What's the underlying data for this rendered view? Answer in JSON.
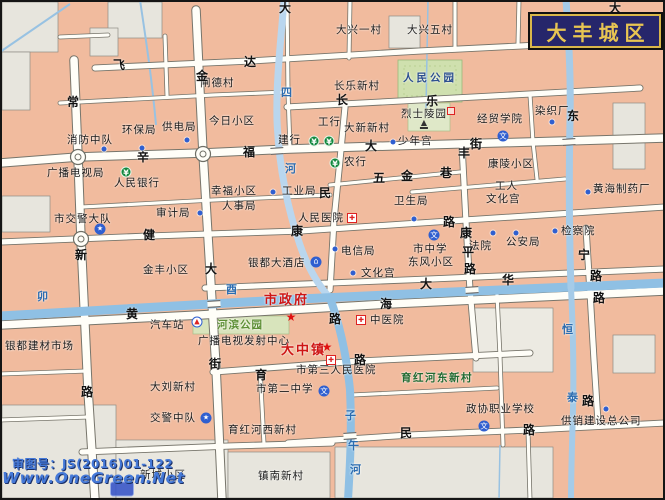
{
  "title": {
    "text": "大丰城区"
  },
  "watermark": {
    "approval": "审图号：JS(2016)01-122",
    "site": "Www.OneGreen.Net"
  },
  "colors": {
    "block": "#f1bb9e",
    "gray_block": "#e7e5dd",
    "road": "#fffef8",
    "river": "#8fc0e4",
    "park": "#cfe0ae",
    "title_bg": "#26266b",
    "title_text": "#e8c552",
    "red_label": "#ce1515"
  },
  "map": {
    "labels": [
      {
        "t": "闸德村",
        "x": 200,
        "y": 78
      },
      {
        "t": "大兴一村",
        "x": 336,
        "y": 25
      },
      {
        "t": "大兴五村",
        "x": 407,
        "y": 25
      },
      {
        "t": "长乐新村",
        "x": 334,
        "y": 81
      },
      {
        "t": "大新新村",
        "x": 344,
        "y": 123
      },
      {
        "t": "今日小区",
        "x": 209,
        "y": 116
      },
      {
        "t": "消防中队",
        "x": 67,
        "y": 135
      },
      {
        "t": "环保局",
        "x": 122,
        "y": 125
      },
      {
        "t": "供电局",
        "x": 162,
        "y": 122
      },
      {
        "t": "广播电视局",
        "x": 47,
        "y": 168
      },
      {
        "t": "人民银行",
        "x": 114,
        "y": 178
      },
      {
        "t": "市交警大队",
        "x": 54,
        "y": 214
      },
      {
        "t": "审计局",
        "x": 156,
        "y": 208
      },
      {
        "t": "人事局",
        "x": 222,
        "y": 201
      },
      {
        "t": "幸福小区",
        "x": 211,
        "y": 186
      },
      {
        "t": "工业局",
        "x": 282,
        "y": 186
      },
      {
        "t": "工行",
        "x": 318,
        "y": 117
      },
      {
        "t": "建行",
        "x": 278,
        "y": 135
      },
      {
        "t": "农行",
        "x": 344,
        "y": 157
      },
      {
        "t": "少年宫",
        "x": 398,
        "y": 136
      },
      {
        "t": "经贸学院",
        "x": 477,
        "y": 114
      },
      {
        "t": "染织厂",
        "x": 535,
        "y": 106
      },
      {
        "t": "烈士陵园",
        "x": 401,
        "y": 109
      },
      {
        "t": "人民公园",
        "x": 403,
        "y": 73,
        "c": "park"
      },
      {
        "t": "卫生局",
        "x": 394,
        "y": 196
      },
      {
        "t": "人民医院",
        "x": 298,
        "y": 213
      },
      {
        "t": "工人",
        "x": 495,
        "y": 181
      },
      {
        "t": "文化宫",
        "x": 486,
        "y": 194
      },
      {
        "t": "黄海制药厂",
        "x": 593,
        "y": 184
      },
      {
        "t": "检察院",
        "x": 561,
        "y": 226
      },
      {
        "t": "法院",
        "x": 469,
        "y": 241
      },
      {
        "t": "公安局",
        "x": 506,
        "y": 237
      },
      {
        "t": "市中学",
        "x": 413,
        "y": 244
      },
      {
        "t": "东风小区",
        "x": 408,
        "y": 257
      },
      {
        "t": "电信局",
        "x": 341,
        "y": 246
      },
      {
        "t": "文化宫",
        "x": 361,
        "y": 268
      },
      {
        "t": "金丰小区",
        "x": 143,
        "y": 265
      },
      {
        "t": "银都大酒店",
        "x": 248,
        "y": 258
      },
      {
        "t": "市政府",
        "x": 264,
        "y": 294,
        "c": "red"
      },
      {
        "t": "大中镇",
        "x": 281,
        "y": 344,
        "c": "red"
      },
      {
        "t": "汽车站",
        "x": 150,
        "y": 320
      },
      {
        "t": "河滨公园",
        "x": 217,
        "y": 320,
        "c": "green"
      },
      {
        "t": "广播电视发射中心",
        "x": 198,
        "y": 336
      },
      {
        "t": "银都建材市场",
        "x": 5,
        "y": 341
      },
      {
        "t": "大刘新村",
        "x": 150,
        "y": 382
      },
      {
        "t": "市第三人民医院",
        "x": 296,
        "y": 365
      },
      {
        "t": "市第二中学",
        "x": 256,
        "y": 384
      },
      {
        "t": "育红河东新村",
        "x": 401,
        "y": 373,
        "c": "gvillage"
      },
      {
        "t": "中医院",
        "x": 370,
        "y": 315
      },
      {
        "t": "交警中队",
        "x": 150,
        "y": 413
      },
      {
        "t": "育红河西新村",
        "x": 228,
        "y": 425
      },
      {
        "t": "新城小区",
        "x": 140,
        "y": 470
      },
      {
        "t": "镇南新村",
        "x": 258,
        "y": 471
      },
      {
        "t": "政协职业学校",
        "x": 466,
        "y": 404
      },
      {
        "t": "供销建设总公司",
        "x": 561,
        "y": 416
      },
      {
        "t": "康陵小区",
        "x": 488,
        "y": 159
      },
      {
        "t": "常",
        "x": 67,
        "y": 96,
        "c": "street"
      },
      {
        "t": "新",
        "x": 75,
        "y": 249,
        "c": "street"
      },
      {
        "t": "路",
        "x": 81,
        "y": 386,
        "c": "street"
      },
      {
        "t": "金",
        "x": 196,
        "y": 70,
        "c": "street"
      },
      {
        "t": "达",
        "x": 244,
        "y": 56,
        "c": "street"
      },
      {
        "t": "飞",
        "x": 113,
        "y": 59,
        "c": "street"
      },
      {
        "t": "大",
        "x": 279,
        "y": 2,
        "c": "street"
      },
      {
        "t": "大",
        "x": 609,
        "y": 2,
        "c": "street"
      },
      {
        "t": "辛",
        "x": 137,
        "y": 151,
        "c": "street"
      },
      {
        "t": "福",
        "x": 243,
        "y": 146,
        "c": "street"
      },
      {
        "t": "大",
        "x": 365,
        "y": 140,
        "c": "street"
      },
      {
        "t": "街",
        "x": 470,
        "y": 138,
        "c": "street"
      },
      {
        "t": "丰",
        "x": 458,
        "y": 147,
        "c": "street"
      },
      {
        "t": "健",
        "x": 143,
        "y": 229,
        "c": "street"
      },
      {
        "t": "康",
        "x": 291,
        "y": 225,
        "c": "street"
      },
      {
        "t": "路",
        "x": 443,
        "y": 216,
        "c": "street"
      },
      {
        "t": "康",
        "x": 460,
        "y": 227,
        "c": "street"
      },
      {
        "t": "平",
        "x": 462,
        "y": 246,
        "c": "street"
      },
      {
        "t": "路",
        "x": 464,
        "y": 263,
        "c": "street"
      },
      {
        "t": "大",
        "x": 205,
        "y": 263,
        "c": "street"
      },
      {
        "t": "街",
        "x": 209,
        "y": 358,
        "c": "street"
      },
      {
        "t": "大",
        "x": 420,
        "y": 278,
        "c": "street"
      },
      {
        "t": "华",
        "x": 502,
        "y": 274,
        "c": "street"
      },
      {
        "t": "路",
        "x": 590,
        "y": 270,
        "c": "street"
      },
      {
        "t": "黄",
        "x": 126,
        "y": 308,
        "c": "street"
      },
      {
        "t": "海",
        "x": 380,
        "y": 298,
        "c": "street"
      },
      {
        "t": "路",
        "x": 329,
        "y": 313,
        "c": "street"
      },
      {
        "t": "路",
        "x": 593,
        "y": 292,
        "c": "street"
      },
      {
        "t": "宁",
        "x": 578,
        "y": 249,
        "c": "street"
      },
      {
        "t": "路",
        "x": 354,
        "y": 354,
        "c": "street"
      },
      {
        "t": "民",
        "x": 400,
        "y": 427,
        "c": "street"
      },
      {
        "t": "路",
        "x": 523,
        "y": 424,
        "c": "street"
      },
      {
        "t": "路",
        "x": 582,
        "y": 395,
        "c": "street"
      },
      {
        "t": "育",
        "x": 255,
        "y": 369,
        "c": "street"
      },
      {
        "t": "五",
        "x": 373,
        "y": 172,
        "c": "street"
      },
      {
        "t": "金",
        "x": 401,
        "y": 170,
        "c": "street"
      },
      {
        "t": "巷",
        "x": 440,
        "y": 167,
        "c": "street"
      },
      {
        "t": "民",
        "x": 319,
        "y": 187,
        "c": "street"
      },
      {
        "t": "长",
        "x": 336,
        "y": 94,
        "c": "street"
      },
      {
        "t": "乐",
        "x": 426,
        "y": 95,
        "c": "street"
      },
      {
        "t": "东",
        "x": 567,
        "y": 110,
        "c": "street"
      },
      {
        "t": "四",
        "x": 281,
        "y": 87,
        "c": "river"
      },
      {
        "t": "河",
        "x": 285,
        "y": 163,
        "c": "river"
      },
      {
        "t": "卯",
        "x": 37,
        "y": 291,
        "c": "river"
      },
      {
        "t": "酉",
        "x": 226,
        "y": 284,
        "c": "river"
      },
      {
        "t": "恒",
        "x": 562,
        "y": 324,
        "c": "river"
      },
      {
        "t": "泰",
        "x": 567,
        "y": 392,
        "c": "river"
      },
      {
        "t": "子",
        "x": 345,
        "y": 410,
        "c": "river"
      },
      {
        "t": "午",
        "x": 348,
        "y": 440,
        "c": "river"
      },
      {
        "t": "河",
        "x": 350,
        "y": 464,
        "c": "river"
      }
    ],
    "icons": [
      {
        "k": "yuan",
        "x": 314,
        "y": 141
      },
      {
        "k": "yuan",
        "x": 329,
        "y": 141
      },
      {
        "k": "yuan",
        "x": 335,
        "y": 163
      },
      {
        "k": "yuan",
        "x": 126,
        "y": 172
      },
      {
        "k": "cross",
        "x": 352,
        "y": 218
      },
      {
        "k": "cross",
        "x": 361,
        "y": 320
      },
      {
        "k": "cross",
        "x": 331,
        "y": 360
      },
      {
        "k": "school",
        "x": 503,
        "y": 136
      },
      {
        "k": "school",
        "x": 434,
        "y": 235
      },
      {
        "k": "school",
        "x": 324,
        "y": 391
      },
      {
        "k": "school",
        "x": 484,
        "y": 426
      },
      {
        "k": "police",
        "x": 100,
        "y": 229
      },
      {
        "k": "police",
        "x": 206,
        "y": 418
      },
      {
        "k": "bus",
        "x": 197,
        "y": 322
      },
      {
        "k": "hotel",
        "x": 316,
        "y": 262
      },
      {
        "k": "redstar",
        "x": 291,
        "y": 317
      },
      {
        "k": "redstar",
        "x": 327,
        "y": 347
      },
      {
        "k": "monument",
        "x": 424,
        "y": 124
      },
      {
        "k": "redbox",
        "x": 451,
        "y": 111
      },
      {
        "k": "dot",
        "x": 393,
        "y": 142
      },
      {
        "k": "dot",
        "x": 552,
        "y": 122
      },
      {
        "k": "dot",
        "x": 588,
        "y": 192
      },
      {
        "k": "dot",
        "x": 555,
        "y": 231
      },
      {
        "k": "dot",
        "x": 493,
        "y": 233
      },
      {
        "k": "dot",
        "x": 516,
        "y": 233
      },
      {
        "k": "dot",
        "x": 414,
        "y": 219
      },
      {
        "k": "dot",
        "x": 353,
        "y": 273
      },
      {
        "k": "dot",
        "x": 335,
        "y": 249
      },
      {
        "k": "dot",
        "x": 200,
        "y": 213
      },
      {
        "k": "dot",
        "x": 273,
        "y": 192
      },
      {
        "k": "dot",
        "x": 104,
        "y": 149
      },
      {
        "k": "dot",
        "x": 142,
        "y": 148
      },
      {
        "k": "dot",
        "x": 187,
        "y": 140
      },
      {
        "k": "dot",
        "x": 606,
        "y": 409
      },
      {
        "k": "bridge",
        "x": 277,
        "y": 151
      },
      {
        "k": "bridge",
        "x": 214,
        "y": 304
      },
      {
        "k": "bridge",
        "x": 472,
        "y": 290
      },
      {
        "k": "bridge",
        "x": 350,
        "y": 436
      },
      {
        "k": "bridge",
        "x": 569,
        "y": 142
      },
      {
        "k": "logo",
        "x": 122,
        "y": 489
      }
    ]
  }
}
